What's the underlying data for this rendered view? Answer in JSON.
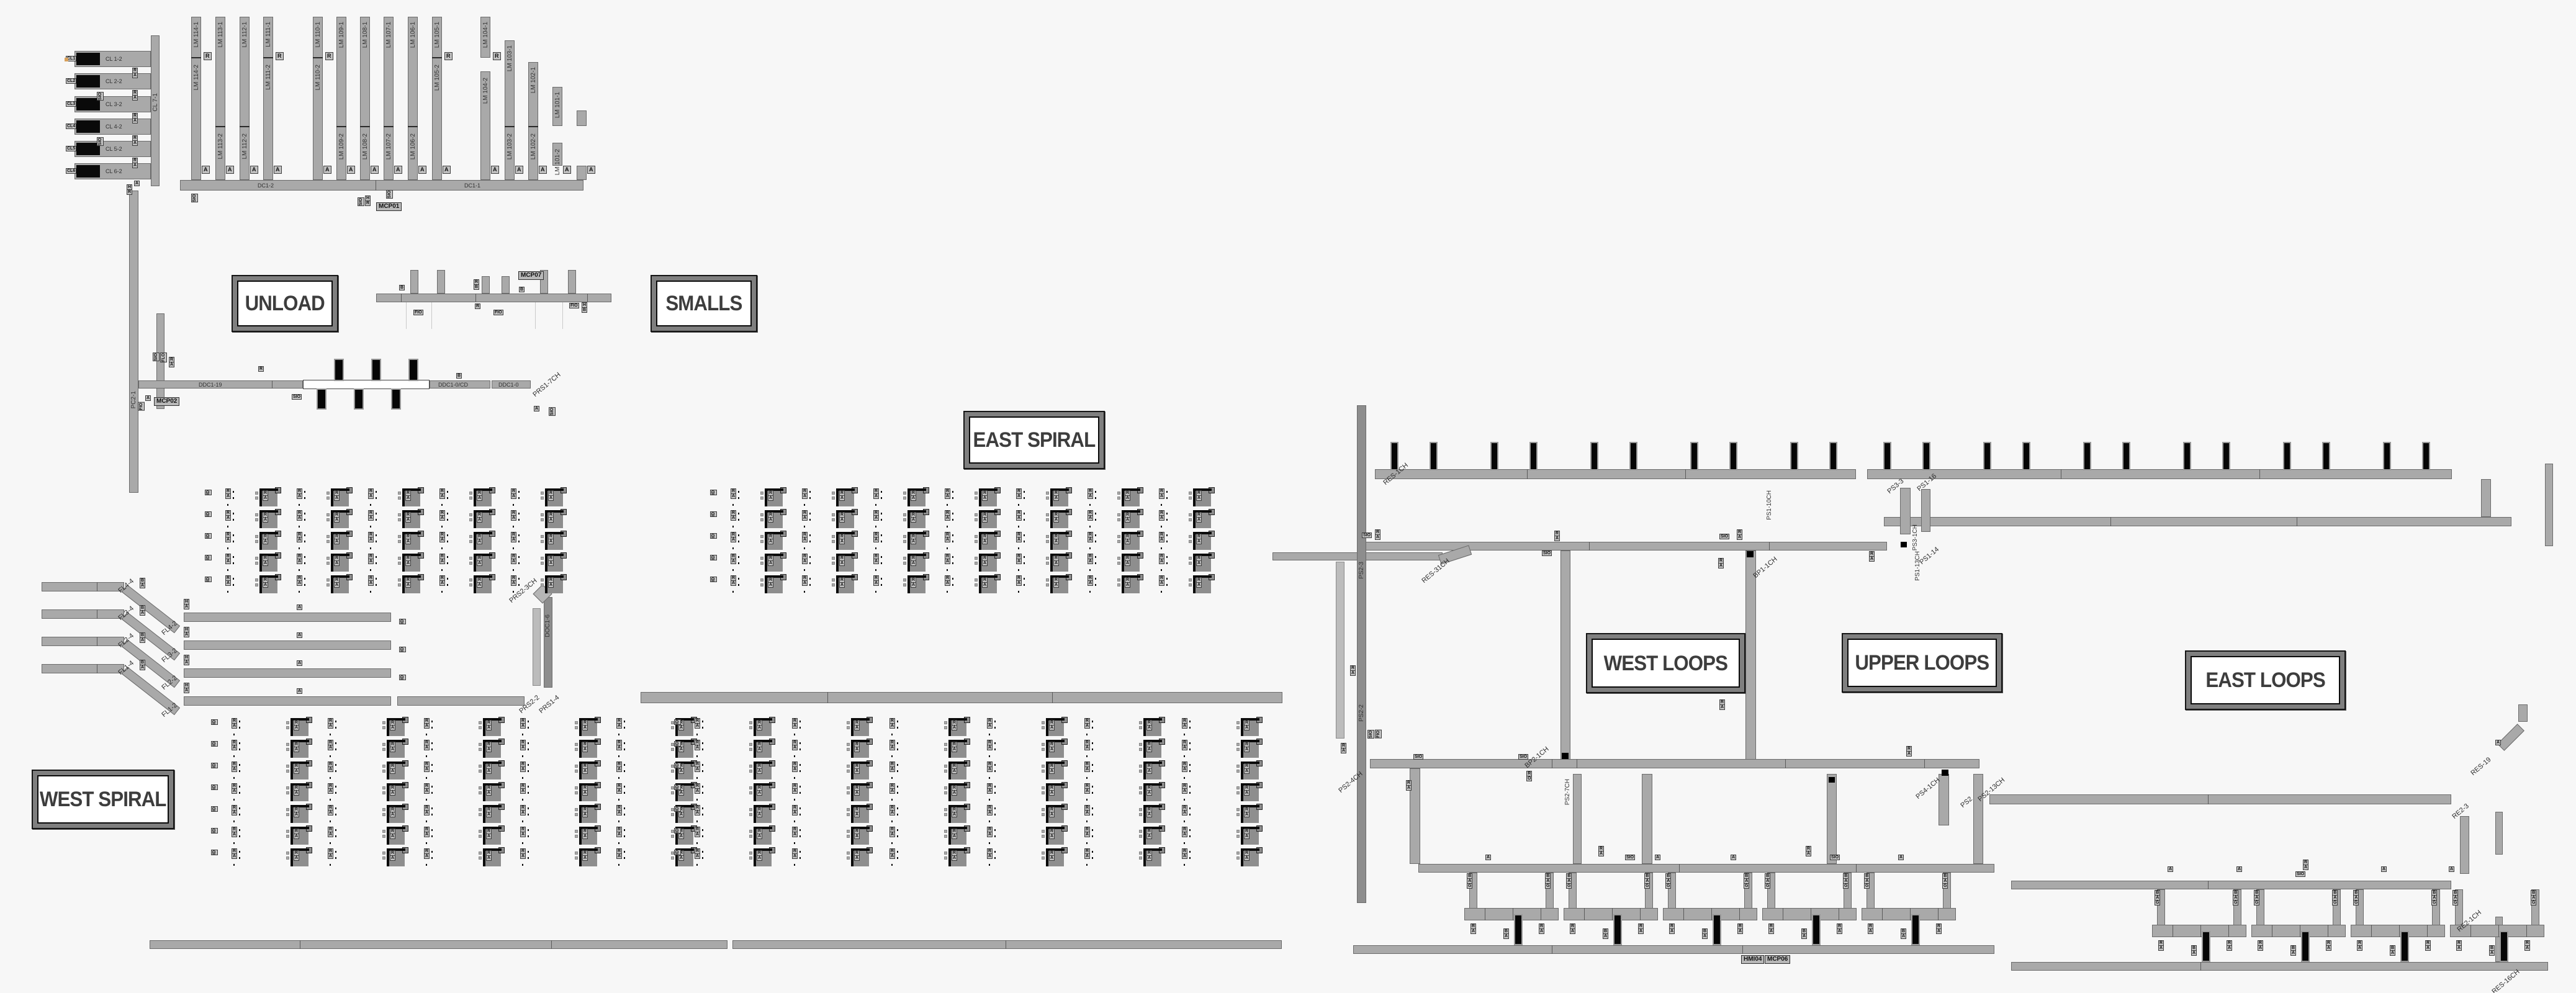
{
  "palette": {
    "background": "#f7f7f7",
    "conveyor": "#a9a9a9",
    "conveyor_border": "#6b6b6b",
    "black_unit": "#060606",
    "tag_bg": "#c2c2c2",
    "label_text": "#3d3d3d",
    "box_frame": "#7f7f7f"
  },
  "boxes": {
    "unload": "UNLOAD",
    "smalls": "SMALLS",
    "east_spiral": "EAST SPIRAL",
    "west_spiral": "WEST SPIRAL",
    "west_loops": "WEST LOOPS",
    "upper_loops": "UPPER LOOPS",
    "east_loops": "EAST LOOPS"
  },
  "t": {
    "r": "R",
    "a": "A",
    "b": "B",
    "g": "G",
    "h": "H",
    "o": "O",
    "d": "D",
    "q": "Q",
    "id": "ID",
    "sio": "SIO",
    "fio": "FIO",
    "flo": "FLO"
  },
  "comb": {
    "dc_left": "DC1-2",
    "dc_right": "DC1-1",
    "lines": [
      {
        "top": "LM 114-1",
        "bottom": "LM 114-2"
      },
      {
        "top": "LM 113-1",
        "bottom": "LM 113-2"
      },
      {
        "top": "LM 112-1",
        "bottom": "LM 112-2"
      },
      {
        "top": "LM 111-1",
        "bottom": "LM 111-2"
      },
      {
        "top": "LM 110-1",
        "bottom": "LM 110-2"
      },
      {
        "top": "LM 109-1",
        "bottom": "LM 109-2"
      },
      {
        "top": "LM 108-1",
        "bottom": "LM 108-2"
      },
      {
        "top": "LM 107-1",
        "bottom": "LM 107-2"
      },
      {
        "top": "LM 106-1",
        "bottom": "LM 106-2"
      },
      {
        "top": "LM 105-1",
        "bottom": "LM 105-2"
      },
      {
        "top": "LM 104-1",
        "bottom": "LM 104-2"
      },
      {
        "top": "LM 103-1",
        "bottom": "LM 103-2"
      },
      {
        "top": "LM 102-1",
        "bottom": "LM 102-2"
      },
      {
        "top": "LM 101-1",
        "bottom": "LM 101-2"
      }
    ]
  },
  "cl": {
    "spine": "CL 7-1",
    "rows": [
      {
        "chip": "CL1",
        "bar": "CL 1-2"
      },
      {
        "chip": "CL2",
        "bar": "CL 2-2"
      },
      {
        "chip": "CL3",
        "bar": "CL 3-2"
      },
      {
        "chip": "CL4",
        "bar": "CL 4-2"
      },
      {
        "chip": "CL5",
        "bar": "CL 5-2"
      },
      {
        "chip": "CL6",
        "bar": "CL 6-2"
      }
    ]
  },
  "mcp": {
    "mcp01": "MCP01",
    "mcp02": "MCP02",
    "mcp07": "MCP07",
    "mcp06": "MCP06",
    "hmi04": "HMI04"
  },
  "ddc": {
    "b19": "DDC1-19",
    "cd": "DDC1-0/CD",
    "b0": "DDC1-0"
  },
  "fl": {
    "ramps": [
      {
        "top": "FL4-4",
        "bottom": "FL4-2"
      },
      {
        "top": "FL3-4",
        "bottom": "FL3-2"
      },
      {
        "top": "FL2-4",
        "bottom": "FL2-2"
      },
      {
        "top": "FL1-4",
        "bottom": "FL1-2"
      }
    ]
  },
  "lines": {
    "pc21": "PC2-1",
    "doc16": "DOC1-6",
    "ps23": "PS2-3",
    "ps22": "PS2-2",
    "ps27ch": "PS2-7CH",
    "ps31ch": "PS3-1CH",
    "ps110ch": "PS1-10CH",
    "ps113ch": "PS1-13CH"
  },
  "diag": {
    "res1ch": "RES-1CH",
    "res31ch": "RES-31CH",
    "res19": "RES-19",
    "res16ch": "RES-16CH",
    "re23": "RE2-3",
    "re21ch": "RE2-1CH",
    "bp11ch": "BP1-1CH",
    "bp21ch": "BP2-1CH",
    "ps114": "PS1-14",
    "ps213ch": "PS2-13CH",
    "ps41ch": "PS4-1CH",
    "ps24ch": "PS2-4CH",
    "ps2": "PS2",
    "ps33": "PS3-3",
    "ps116": "PS1-16",
    "prs17ch": "PRS1-7CH",
    "prs23ch": "PRS2-3CH",
    "prs22": "PRS2-2",
    "prs14": "PRS1-4"
  }
}
